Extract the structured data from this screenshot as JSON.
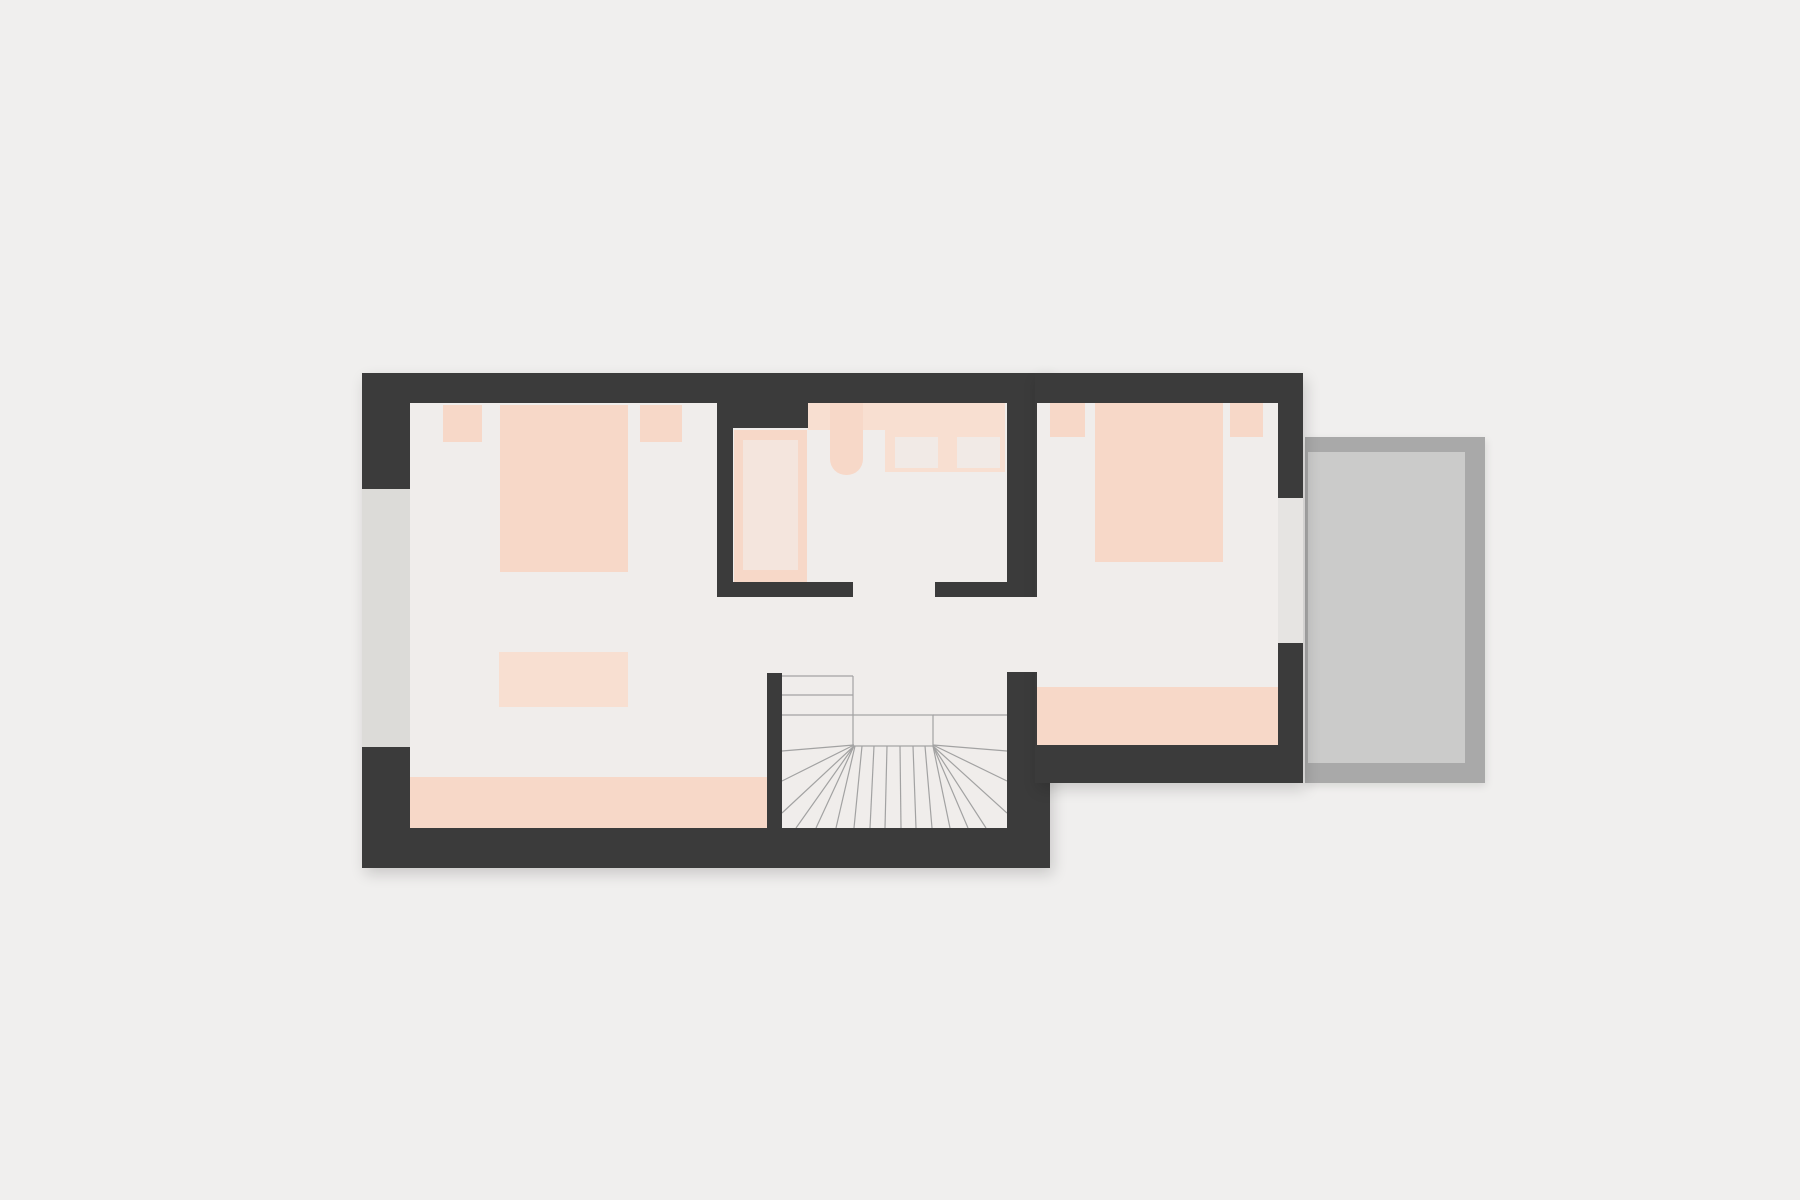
{
  "document": {
    "type": "architectural-floor-plan",
    "view": "top-down-2d",
    "visible_text": "none"
  },
  "plan": {
    "rooms": [
      {
        "id": "bedroom-left",
        "furniture": [
          "nightstand",
          "double-bed",
          "nightstand",
          "rug",
          "wardrobe-strip"
        ]
      },
      {
        "id": "bathroom",
        "furniture": [
          "bathtub",
          "counter",
          "washbasin",
          "appliance",
          "appliance"
        ]
      },
      {
        "id": "hallway",
        "furniture": [
          "winder-staircase"
        ]
      },
      {
        "id": "bedroom-right",
        "furniture": [
          "nightstand",
          "double-bed",
          "nightstand",
          "dresser-strip"
        ]
      },
      {
        "id": "balcony",
        "furniture": []
      }
    ],
    "openings": [
      "window-left-wall",
      "bathroom-door",
      "bedroom-right-door",
      "balcony-door"
    ]
  },
  "colors": {
    "bg": "#f0efee",
    "wall": "#3b3b3b",
    "floor": "#f0edeb",
    "window_glass": "#dcdbd8",
    "door_opening": "#e6e4e2",
    "balcony_border": "#a9a9a9",
    "balcony_floor": "#cbcbca",
    "pink": "#f7d8c8",
    "pink_soft": "#f8dfd1",
    "tub_inner": "#f4e5dd",
    "appliance": "#f1eae6",
    "stair_line": "#a2a2a2"
  }
}
